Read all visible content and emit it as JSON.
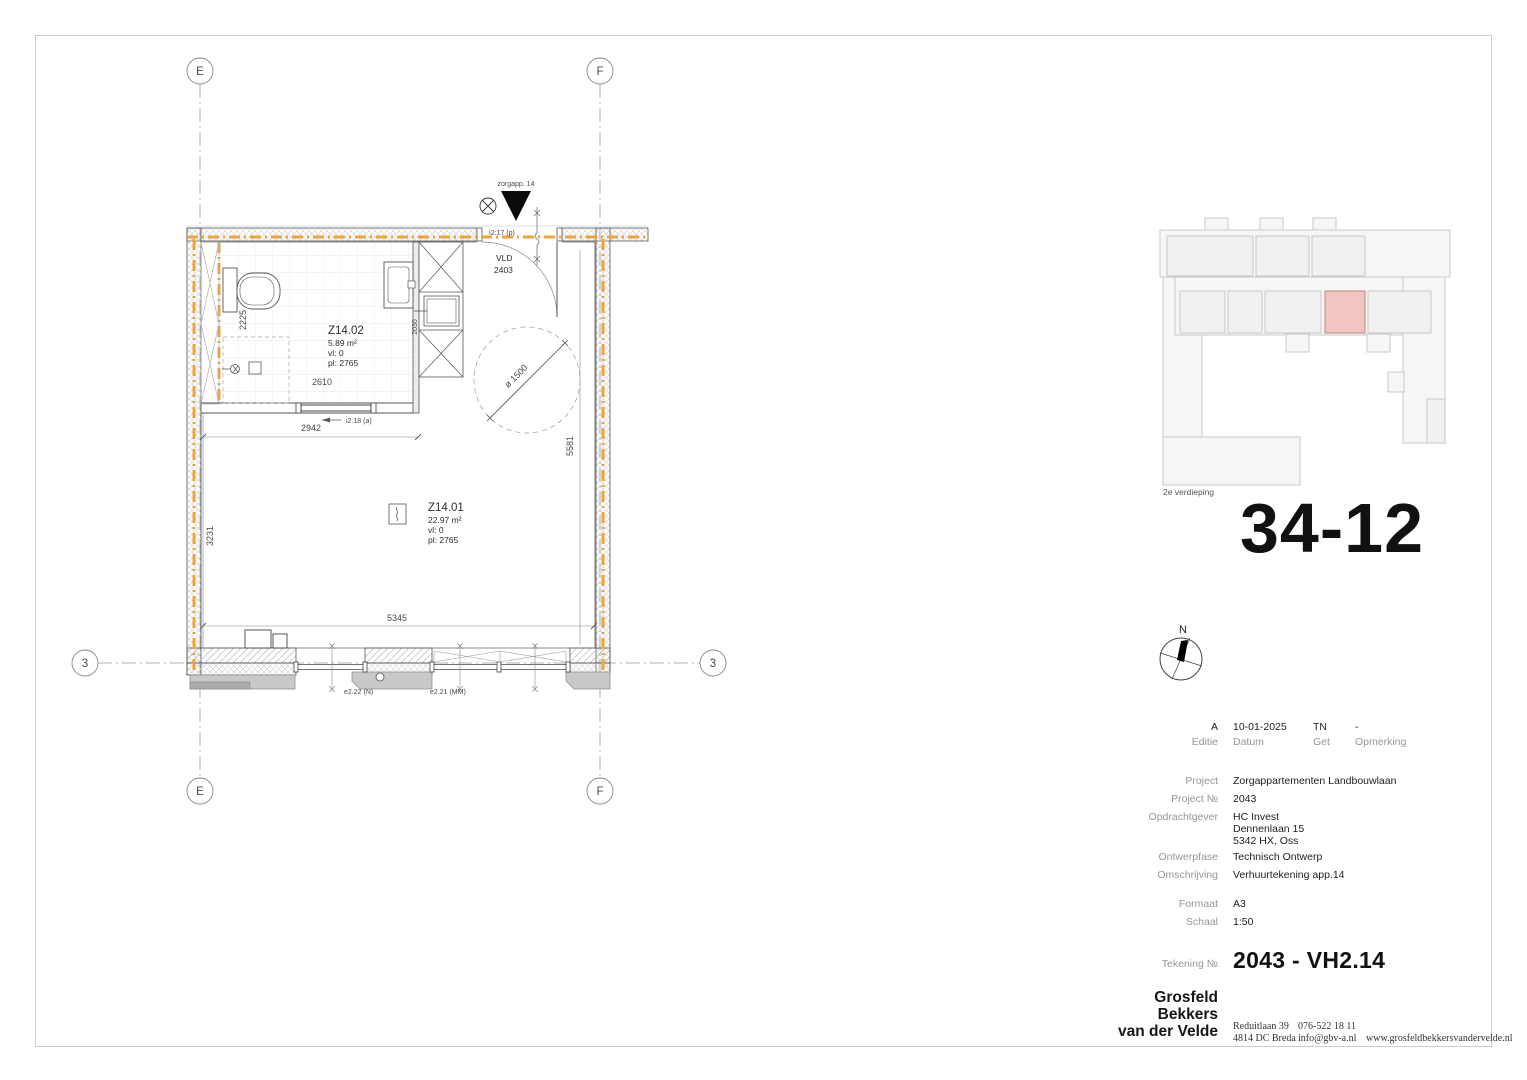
{
  "plan": {
    "grid": {
      "e": "E",
      "f": "F",
      "three": "3"
    },
    "entrance": {
      "apartment": "zorgapp. 14",
      "door_code": "i2:17 (p)",
      "vld": "VLD",
      "vld_number": "2403"
    },
    "bathroom": {
      "id": "Z14.02",
      "area": "5.89 m²",
      "vl": "vl: 0",
      "pl": "pl: 2765"
    },
    "living": {
      "id": "Z14.01",
      "area": "22.97 m²",
      "vl": "vl: 0",
      "pl": "pl: 2765"
    },
    "interior_door": "i2.18 (a)",
    "window_left": "e2.22 (N)",
    "window_right": "e2.21 (MM)",
    "dims": {
      "bath_height": "2225",
      "bath_width": "2610",
      "hall_width": "2942",
      "living_height": "3231",
      "room_height": "5581",
      "room_width": "5345",
      "shaft": "2030",
      "turning_circle": "ø 1500"
    }
  },
  "keyplan": {
    "caption": "2e verdieping",
    "unit": "34-12"
  },
  "north": {
    "label": "N"
  },
  "titleblock": {
    "revision": {
      "editie": "A",
      "datum": "10-01-2025",
      "get": "TN",
      "opmerking": "-",
      "editie_label": "Editie",
      "datum_label": "Datum",
      "get_label": "Get",
      "opmerking_label": "Opmerking"
    },
    "project_label": "Project",
    "project": "Zorgappartementen Landbouwlaan",
    "projectno_label": "Project №",
    "projectno": "2043",
    "client_label": "Opdrachtgever",
    "client_line1": "HC Invest",
    "client_line2": "Dennenlaan 15",
    "client_line3": "5342 HX,  Oss",
    "phase_label": "Ontwerpfase",
    "phase": "Technisch Ontwerp",
    "descr_label": "Omschrijving",
    "descr": "Verhuurtekening app.14",
    "format_label": "Formaat",
    "format": "A3",
    "scale_label": "Schaal",
    "scale": "1:50",
    "drawingno_label": "Tekening №",
    "drawingno": "2043 - VH2.14"
  },
  "firm": {
    "name_line1": "Grosfeld",
    "name_line2": "Bekkers",
    "name_line3": "van der Velde",
    "address_line1": "Reduitlaan 39",
    "address_line2": "4814 DC Breda",
    "phone": "076-522 18 11",
    "email": "info@gbv-a.nl",
    "website": "www.grosfeldbekkersvandervelde.nl"
  }
}
